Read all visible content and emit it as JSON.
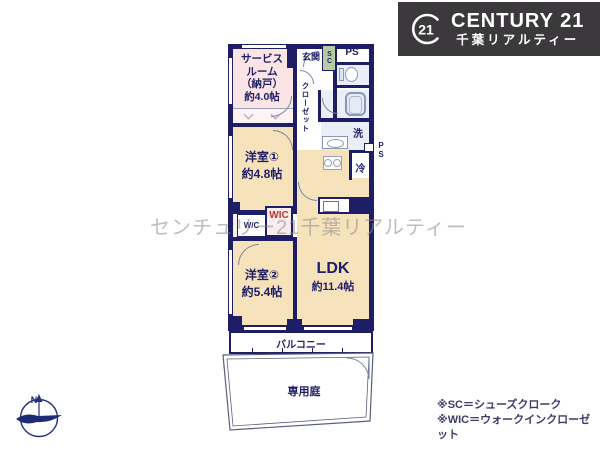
{
  "logo": {
    "seal": "21",
    "brand": "CENTURY 21",
    "company": "千葉リアルティー",
    "bg_color": "#3b393b",
    "text_color": "#ffffff"
  },
  "watermark": "センチュリー21千葉リアルティー",
  "plan": {
    "wall_color": "#1e1e66",
    "room_color": "#f6e2bb",
    "service_room_color": "#fbe4e4",
    "sc_box_color": "#b6cba4",
    "wic_label_color": "#c03434",
    "rooms": {
      "service": "サービス\nルーム\n（納戸）\n約4.0帖",
      "room1": "洋室①\n約4.8帖",
      "room2": "洋室②\n約5.4帖",
      "ldk_name": "LDK",
      "ldk_size": "約11.4帖"
    },
    "labels": {
      "genkan": "玄関",
      "sc": "SC",
      "ps_top": "PS",
      "ps_side": "P\nS",
      "closet": "クローゼット",
      "laundry": "洗",
      "fridge": "冷",
      "wc": "W/C",
      "wic": "WIC",
      "balcony": "バルコニー",
      "garden": "専用庭"
    }
  },
  "compass": {
    "north": "N"
  },
  "notes": {
    "sc": "※SC＝シューズクローク",
    "wic": "※WIC＝ウォークインクローゼット"
  }
}
